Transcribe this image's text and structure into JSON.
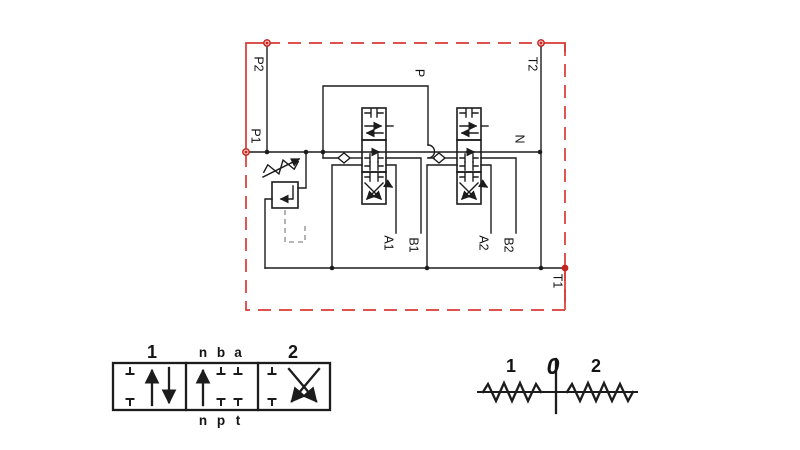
{
  "circuit": {
    "ports": {
      "p2": "P2",
      "t2": "T2",
      "p1": "P1",
      "t1": "T1",
      "n": "N",
      "p": "P",
      "a1": "A1",
      "b1": "B1",
      "a2": "A2",
      "b2": "B2"
    }
  },
  "spool_diagram": {
    "pos_left": "1",
    "top_n": "n",
    "top_b": "b",
    "top_a": "a",
    "pos_right": "2",
    "bot_n": "n",
    "bot_p": "p",
    "bot_t": "t"
  },
  "lever_diagram": {
    "left": "1",
    "center": "0",
    "right": "2"
  },
  "colors": {
    "boundary_red": "#d93a35",
    "line_black": "#1c1c1c",
    "pilot_gray": "#8a8a8a"
  }
}
